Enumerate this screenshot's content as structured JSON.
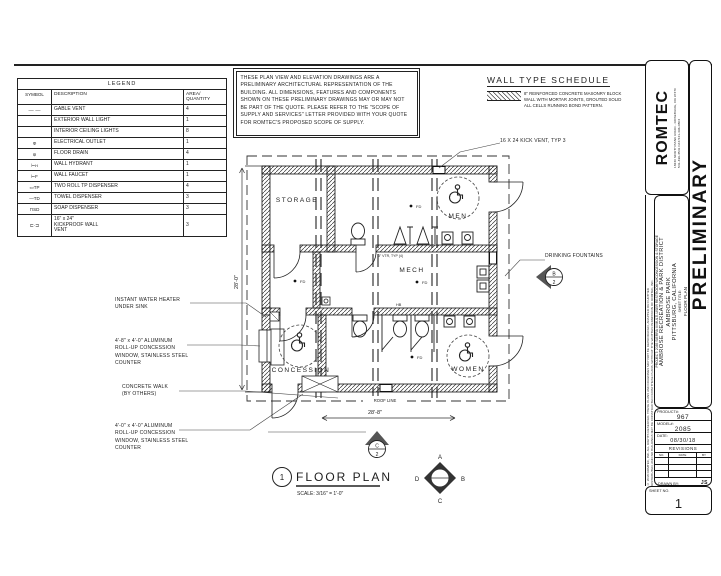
{
  "colors": {
    "ink": "#1d1d1d",
    "paper": "#ffffff"
  },
  "sheet": {
    "drawing_number": "1",
    "drawing_title": "FLOOR PLAN",
    "drawing_scale": "SCALE: 3/16\" = 1'-0\""
  },
  "legend": {
    "title": "LEGEND",
    "col_symbol": "SYMBOL",
    "col_description": "DESCRIPTION",
    "col_qty": "AREA/\nQUANTITY",
    "rows": [
      {
        "symbol": "—··—",
        "description": "GABLE VENT",
        "qty": "4"
      },
      {
        "symbol": "",
        "description": "EXTERIOR WALL LIGHT",
        "qty": "1"
      },
      {
        "symbol": "",
        "description": "INTERIOR CEILING LIGHTS",
        "qty": "8"
      },
      {
        "symbol": "Φ",
        "description": "ELECTRICAL OUTLET",
        "qty": "1"
      },
      {
        "symbol": "⊚",
        "description": "FLOOR DRAIN",
        "qty": "4"
      },
      {
        "symbol": "⊢ʜ",
        "description": "WALL HYDRANT",
        "qty": "1"
      },
      {
        "symbol": "⊢F",
        "description": "WALL FAUCET",
        "qty": "1"
      },
      {
        "symbol": "▭TP",
        "description": "TWO ROLL TP DISPENSER",
        "qty": "4"
      },
      {
        "symbol": "—TD",
        "description": "TOWEL DISPENSER",
        "qty": "3"
      },
      {
        "symbol": "⊓SD",
        "description": "SOAP DISPENSER",
        "qty": "3"
      },
      {
        "symbol": "⊏·⊐",
        "description": "16\" x 24\"\nKICKPROOF WALL\nVENT",
        "qty": "3"
      }
    ]
  },
  "notes": {
    "text": "THESE PLAN VIEW AND ELEVATION DRAWINGS ARE A PRELIMINARY ARCHITECTURAL REPRESENTATION OF THE BUILDING. ALL DIMENSIONS, FEATURES AND COMPONENTS SHOWN ON THESE PRELIMINARY DRAWINGS MAY OR MAY NOT BE PART OF THE QUOTE. PLEASE REFER TO THE \"SCOPE OF SUPPLY AND SERVICES\" LETTER PROVIDED WITH YOUR QUOTE FOR ROMTEC'S PROPOSED SCOPE OF SUPPLY."
  },
  "wall_type_schedule": {
    "title": "WALL TYPE SCHEDULE",
    "entry": "8\" REINFORCED CONCRETE MASONRY BLOCK WALL WITH MORTAR JOINTS, GROUTED SOLID ALL CELLS RUNNING BOND PATTERN."
  },
  "plan": {
    "rooms": {
      "storage": "STORAGE",
      "men": "MEN",
      "mech": "MECH",
      "concession": "CONCESSION",
      "women": "WOMEN"
    },
    "callouts": {
      "kick_vent": "16 X 24 KICK VENT, TYP 3",
      "drinking_fountains": "DRINKING FOUNTAINS",
      "water_heater": "INSTANT WATER HEATER\nUNDER SINK",
      "window_1": "4'-8\" x 4'-0\" ALUMINUM\nROLL-UP CONCESSION\nWINDOW, STAINLESS STEEL\nCOUNTER",
      "concrete_walk": "CONCRETE WALK\n(BY OTHERS)",
      "window_2": "4'-0\" x 4'-0\" ALUMINUM\nROLL-UP CONCESSION\nWINDOW, STAINLESS STEEL\nCOUNTER",
      "vtr": "3\" VTR, TYP (4)",
      "hb": "HB",
      "fd": "FD"
    },
    "dimensions": {
      "width_left": "28'-0\"",
      "width_bottom": "28'-8\"",
      "roof_line": "ROOF LINE"
    },
    "markers": {
      "section_c": "C",
      "section_c_num": "2",
      "section_b": "B",
      "section_b_num": "2",
      "dir_a": "A",
      "dir_b": "B",
      "dir_c": "C",
      "dir_d": "D"
    }
  },
  "title_block": {
    "logo": "ROMTEC",
    "address": "18240 NORTH BANK ROAD - ROSEBURG, OR 97470",
    "phone": "541-496-3541   FAX 541-496-0803",
    "watermark": "PRELIMINARY",
    "copyright_1": "© 2018 ROMTEC, INC. ALL RIGHTS RESERVED. THESE PLANS AND DRAWINGS MAY NOT BE REPRODUCED, ADAPTED OR FURTHER",
    "copyright_2": "DISTRIBUTED, AND NO BUILDINGS MAY BE CONSTRUCTED FROM THESE PLANS, WITHOUT THE WRITTEN PERMISSION OF ROMTEC, INC.",
    "project_line": "PROJECT: 2085 SIERRA III MULTI-USER RESTROOM W/CONCESSION & STORAGE",
    "client": "AMBROSE RECREATION & PARK DISTRICT",
    "park": "AMBROSE PARK",
    "city": "PITTSBURG, CALIFORNIA",
    "sheet_title_label": "SHEET TITLE:",
    "sheet_title": "FLOOR PLAN",
    "product_label": "PRODUCT#:",
    "product_value": "967",
    "model_label": "MODEL#:",
    "model_value": "2085",
    "date_label": "DATE:",
    "date_value": "08/30/18",
    "revisions_label": "REVISIONS",
    "rev_cols": [
      "NO.",
      "DATE",
      "BY"
    ],
    "drawn_by_label": "DRAWN BY:",
    "drawn_by_value": "JS",
    "sheet_no_label": "SHEET NO.",
    "sheet_no_value": "1"
  }
}
